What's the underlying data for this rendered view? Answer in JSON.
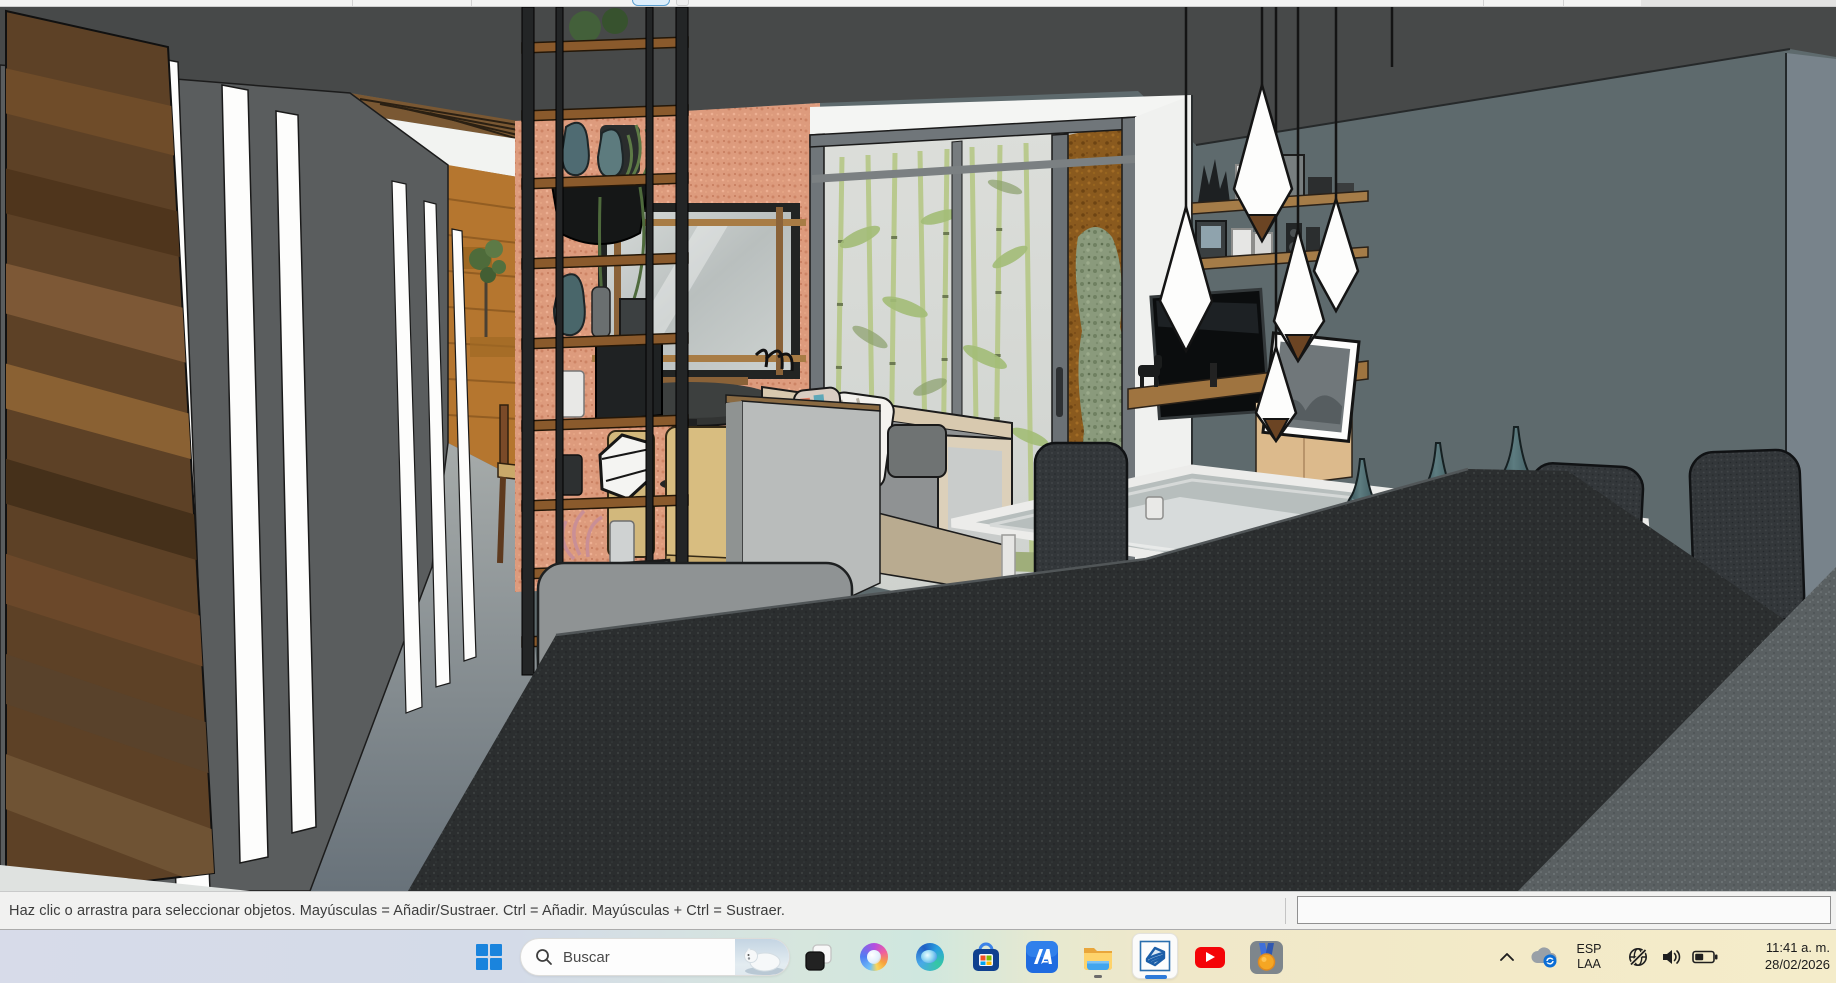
{
  "top_strip": {
    "partial_button_accent": "#5b9fd0"
  },
  "status_bar": {
    "hint": "Haz clic o arrastra para seleccionar objetos. Mayúsculas = Añadir/Sustraer. Ctrl = Añadir. Mayúsculas + Ctrl = Sustraer.",
    "measurements_value": ""
  },
  "taskbar": {
    "search": {
      "placeholder": "Buscar"
    },
    "apps": [
      "start",
      "task-view",
      "copilot",
      "edge",
      "microsoft-store",
      "slash-a-app",
      "file-explorer",
      "sketchup",
      "youtube",
      "medal"
    ],
    "active_app": "sketchup",
    "running_apps": [
      "file-explorer",
      "sketchup"
    ],
    "accent_color": "#1a84dd",
    "tray": {
      "language_line1": "ESP",
      "language_line2": "LAA",
      "time": "11:41 a. m.",
      "date": "28/02/2026"
    }
  },
  "scene": {
    "description": "SketchUp interior model: corridor with slit-lit wall and wood door, shelf tower, salmon accent wall with mirror, glass door with bamboo patio, TV wall with pendant lamps, dining table with vases, dark stone counter",
    "palette": {
      "ceiling": "#474949",
      "left_wall": "#5a5d5e",
      "door_wood": "#5d4126",
      "corridor_wood": "#b5762f",
      "salmon_wall": "#dd9b7d",
      "right_wall": "#5e6a6d",
      "glass": "#d7dad6",
      "bamboo": "#b9c98e",
      "rust_wall": "#8a5a1e",
      "counter_dark": "#2b2e2f",
      "counter_light": "#5a6062",
      "shelf_wood": "#8a5a2c",
      "vase_teal": "#4f6b72",
      "chair_tan": "#d5ba7e",
      "lamp_white": "#fdfdfc"
    }
  }
}
